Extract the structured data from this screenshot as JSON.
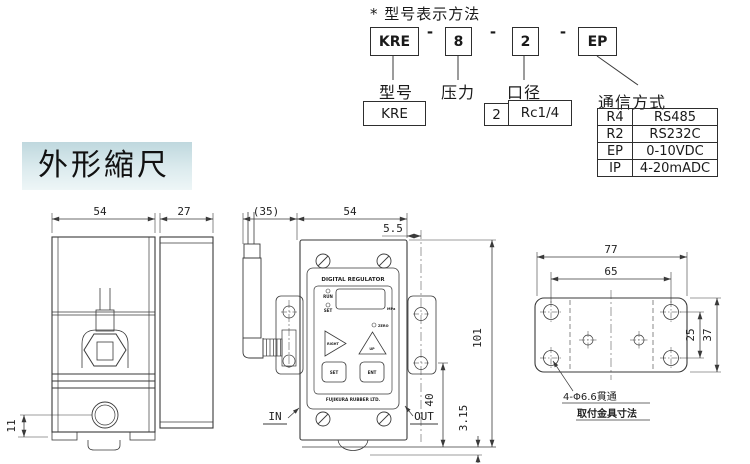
{
  "model_section": {
    "title": "* 型号表示方法",
    "separator": "-",
    "codes": {
      "model": "KRE",
      "pressure": "8",
      "bore": "2",
      "comm": "EP"
    },
    "labels": {
      "model": "型号",
      "pressure": "压力",
      "bore": "口径",
      "comm": "通信方式"
    },
    "model_value": "KRE",
    "bore_size": "2",
    "bore_thread": "Rc1/4",
    "comm_options": [
      {
        "code": "R4",
        "value": "RS485"
      },
      {
        "code": "R2",
        "value": "RS232C"
      },
      {
        "code": "EP",
        "value": "0-10VDC"
      },
      {
        "code": "IP",
        "value": "4-20mADC"
      }
    ]
  },
  "scale_banner": "外形縮尺",
  "side_view": {
    "width": "54",
    "depth": "27",
    "port_height": "11"
  },
  "front_view": {
    "connector": "(35)",
    "width": "54",
    "offset": "5.5",
    "height": "101",
    "out_height": "40",
    "foot": "3.15",
    "inlet": "IN",
    "outlet": "OUT",
    "panel": {
      "title": "DIGITAL REGULATOR",
      "led_run": "RUN",
      "led_set": "SET",
      "led_zero": "ZERO",
      "unit": "MPa",
      "btn_right": "RIGHT",
      "btn_up": "UP",
      "btn_set": "SET",
      "btn_ent": "ENT",
      "brand": "FUJIKURA RUBBER LTD."
    }
  },
  "mount_view": {
    "width": "77",
    "hole_span_x": "65",
    "hole_span_y": "25",
    "height": "37",
    "hole_note": "4-Φ6.6貫通",
    "caption": "取付金具寸法"
  },
  "colors": {
    "line": "#3a3a3a",
    "banner_top": "#bfd8de",
    "banner_bottom": "#eef6f7"
  }
}
